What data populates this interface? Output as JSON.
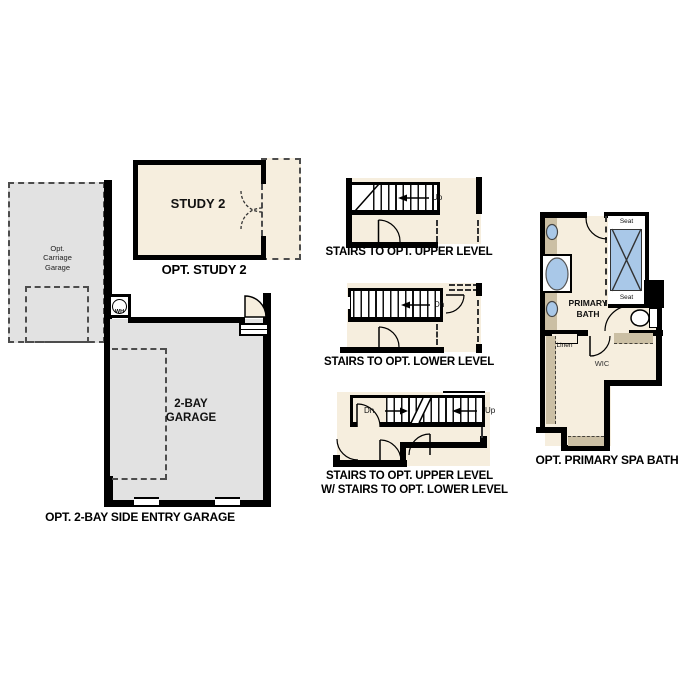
{
  "plan_title": "floor plan option details",
  "study": {
    "room_label": "STUDY 2",
    "caption": "OPT. STUDY 2"
  },
  "carriage_garage": {
    "label": "Opt.\nCarriage\nGarage"
  },
  "garage": {
    "room_label": "2-BAY\nGARAGE",
    "caption": "OPT. 2-BAY SIDE ENTRY GARAGE",
    "water_heater": "WH"
  },
  "stairs_upper": {
    "caption": "STAIRS TO OPT. UPPER LEVEL",
    "direction": "Up"
  },
  "stairs_lower": {
    "caption": "STAIRS TO OPT. LOWER LEVEL",
    "direction": "Dn"
  },
  "stairs_combo": {
    "caption_line1": "STAIRS TO OPT. UPPER LEVEL",
    "caption_line2": "W/ STAIRS TO OPT. LOWER LEVEL",
    "down": "Dn",
    "up": "Up"
  },
  "bath": {
    "room_label": "PRIMARY\nBATH",
    "caption": "OPT. PRIMARY SPA BATH",
    "seat_top": "Seat",
    "seat_bottom": "Seat",
    "linen": "Linen",
    "closet": "WIC"
  },
  "colors": {
    "floor_cream": "#f6eede",
    "garage_gray": "#e2e2e2",
    "counter_tan": "#cbbfa4",
    "fixture_blue": "#a9c8e8",
    "wall_black": "#000000"
  }
}
